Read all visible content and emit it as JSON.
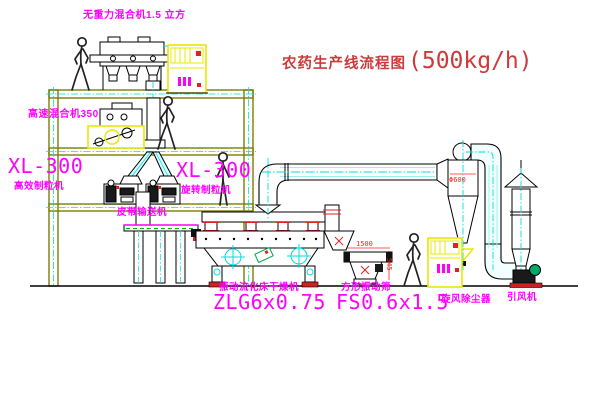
{
  "title": {
    "text": "农药生产线流程图",
    "capacity": "(500kg/h)"
  },
  "equipment_labels": {
    "no_gravity_mixer": "无重力混合机1.5 立方",
    "high_speed_mixer": "高速混合机350",
    "granulator_left_model": "XL-300",
    "granulator_left_name": "高效制粒机",
    "granulator_mid_model": "XL-300",
    "granulator_mid_name": "旋转制粒机",
    "belt_conveyor": "皮带输送机",
    "dryer_name": "振动流化床干燥机",
    "dryer_model": "ZLG6x0.75",
    "sieve_name": "方形振动筛",
    "sieve_model": "FS0.6x1.5",
    "cyclone": "旋风除尘器",
    "fan": "引风机"
  },
  "dimensions": {
    "cyclone_diameter": "Φ600",
    "sieve_length": "1500",
    "sieve_height": "545"
  },
  "colors": {
    "label_magenta": "#ff00ff",
    "title_red": "#cd3a3a",
    "dimension_red": "#ff2222",
    "machine_yellow": "#e8e800",
    "pipe_cyan": "#00dede",
    "structure_olive": "#7d7d00",
    "fan_green": "#00a86b"
  }
}
